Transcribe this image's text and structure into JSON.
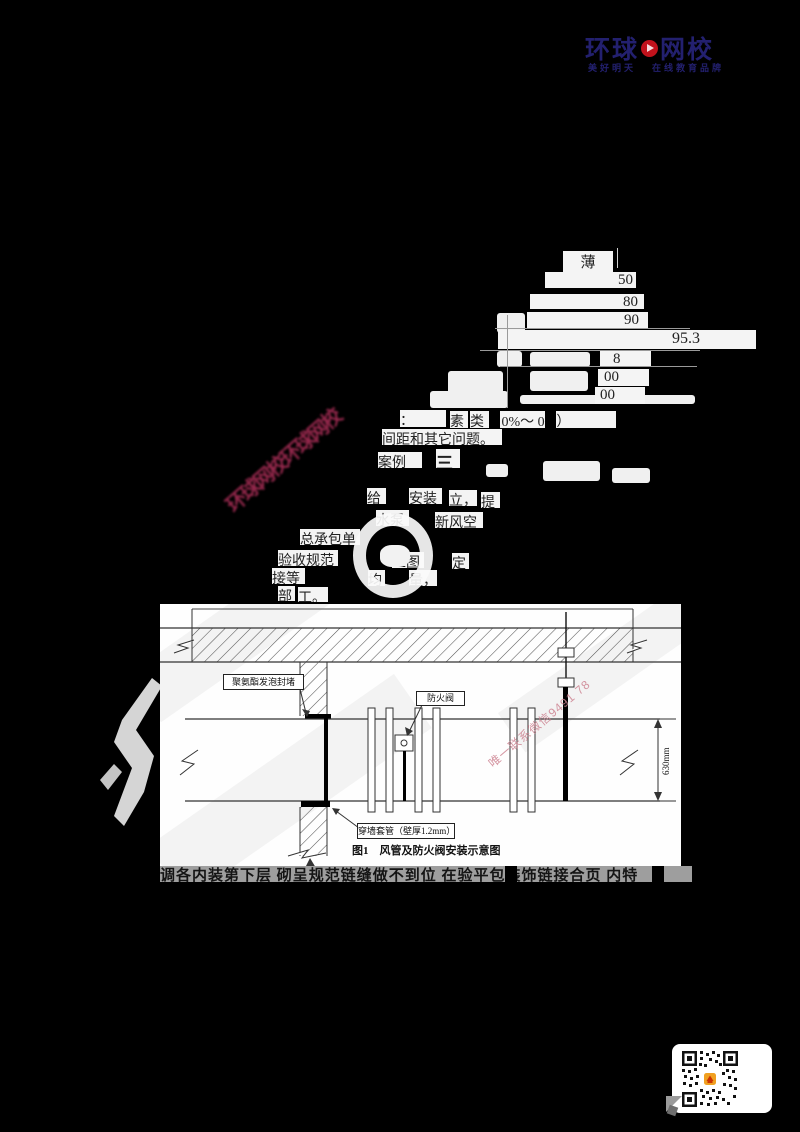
{
  "logo": {
    "part1": "环球",
    "part2": "网校",
    "tagline_left": "美好明天",
    "tagline_right": "在线教育品牌"
  },
  "watermark": {
    "streak_text": "环球网校环球网校",
    "contact_text": "唯一联系微信9491 78"
  },
  "table": {
    "header_char": "薄",
    "v1": "50",
    "v2": "80",
    "v3": "90",
    "v4": "95.3",
    "v5": "8",
    "v6": "00",
    "v7": "00"
  },
  "fragments": {
    "colon": "：",
    "su": "素",
    "lei_pct": "类（ 0%～ 0%）",
    "line2": "间距和其它问题。",
    "anli": "案例",
    "san": "三",
    "gei": "给",
    "anzhuang": "安装",
    "li": "立，",
    "ti": "提",
    "shuibeng": "水泵",
    "xinfengkong": "新风空",
    "zongchengbao": "总承包单",
    "yanshou": "验收规范",
    "gongtu": "工图",
    "ding": "定",
    "jiedeng": "接等",
    "jun": "均",
    "liang": "量，",
    "bu": "部",
    "gong": "工。"
  },
  "diagram": {
    "label_foam": "聚氨酯发泡封堵",
    "label_damper": "防火阀",
    "label_sleeve": "穿墙套管（壁厚1.2mm）",
    "caption": "图1　风管及防火阀安装示意图",
    "dimension": "630mm"
  },
  "bottom_line": "调各内装第下层 砌呈规范链缝做不到位 在验平包装饰链接合页 内特",
  "colors": {
    "logo_navy": "#23206f",
    "logo_red": "#c1121c",
    "streak_red": "#9c2a50",
    "contact_pink": "#cd8290",
    "qr_center": "#f0a020"
  }
}
